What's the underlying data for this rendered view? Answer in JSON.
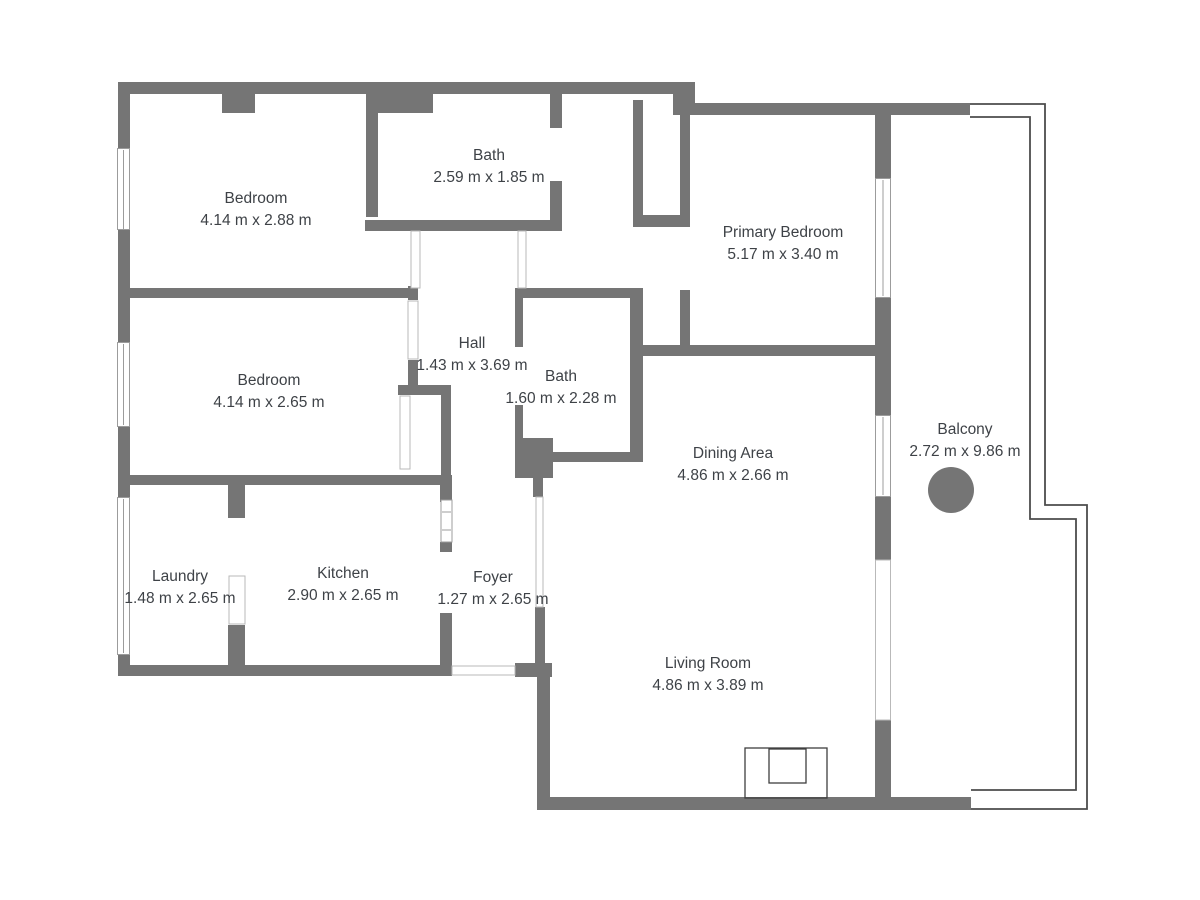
{
  "colors": {
    "wall": "#757575",
    "text": "#3e4247",
    "win-line": "#9c9c9c",
    "door-line": "#b9b9b9",
    "balcony-line": "#4c4c4c",
    "bg": "#ffffff"
  },
  "rooms": [
    {
      "name": "Bedroom",
      "dims": "4.14 m x 2.88 m"
    },
    {
      "name": "Bath",
      "dims": "2.59 m x 1.85 m"
    },
    {
      "name": "Primary Bedroom",
      "dims": "5.17 m x 3.40 m"
    },
    {
      "name": "Bedroom",
      "dims": "4.14 m x 2.65 m"
    },
    {
      "name": "Hall",
      "dims": "1.43 m x 3.69 m"
    },
    {
      "name": "Bath",
      "dims": "1.60 m x 2.28 m"
    },
    {
      "name": "Dining Area",
      "dims": "4.86 m x 2.66 m"
    },
    {
      "name": "Balcony",
      "dims": "2.72 m x 9.86 m"
    },
    {
      "name": "Laundry",
      "dims": "1.48 m x 2.65 m"
    },
    {
      "name": "Kitchen",
      "dims": "2.90 m x 2.65 m"
    },
    {
      "name": "Foyer",
      "dims": "1.27 m x 2.65 m"
    },
    {
      "name": "Living Room",
      "dims": "4.86 m x 3.89 m"
    }
  ],
  "furniture": {
    "balcony_table": "round-table",
    "living_room_fixture": "fireplace"
  }
}
